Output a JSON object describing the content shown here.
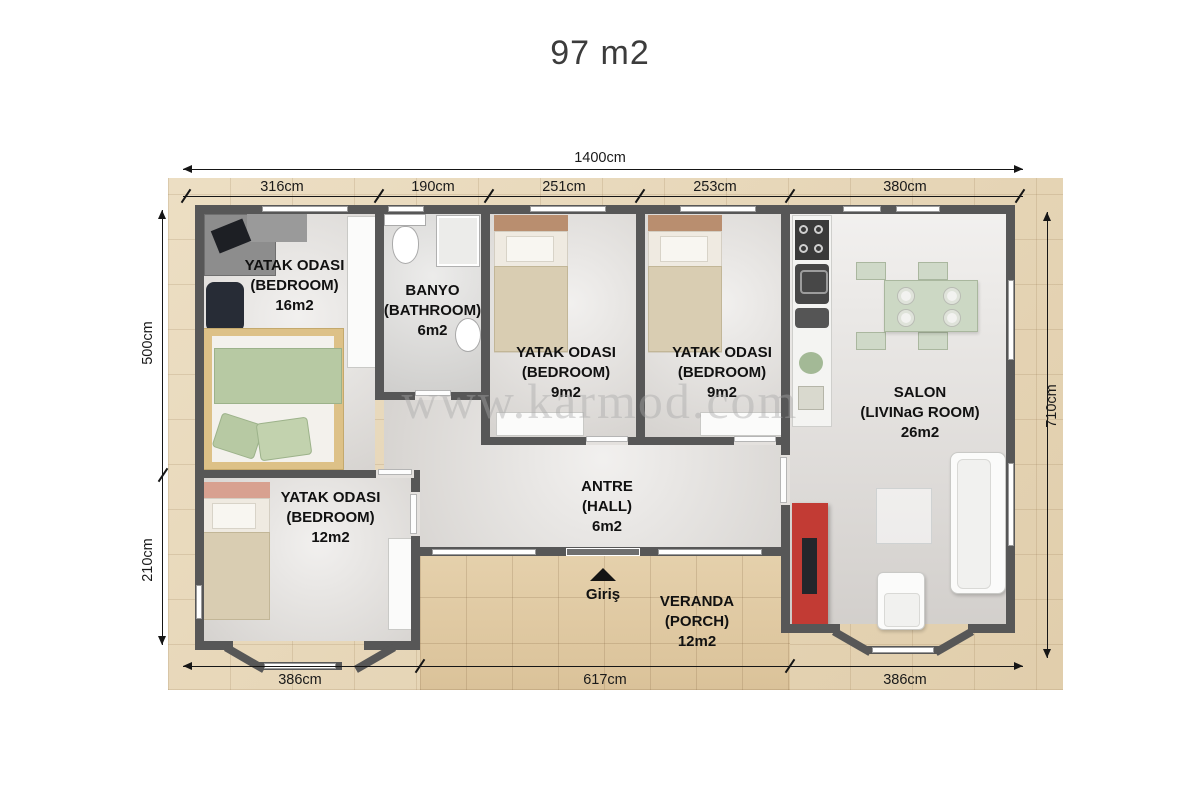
{
  "title": "97 m2",
  "watermark": "www.karmod.com",
  "colors": {
    "wall": "#575757",
    "mat": "#e8d7b6",
    "veranda": "#e2cba2",
    "floor": "#e4e1de",
    "salon_floor": "#e7e4e1",
    "accent_red": "#c23b34",
    "bed_green": "#b7c9a3",
    "bed_frame": "#ddc187",
    "bed_tan": "#d9cdb2",
    "headboard_brown": "#b98e6f",
    "headboard_peach": "#d8a190",
    "dim_text": "#1a1a1a",
    "watermark_gray": "#a8a8a8"
  },
  "dims": {
    "top_total": "1400cm",
    "top_segments": [
      "316cm",
      "190cm",
      "251cm",
      "253cm",
      "380cm"
    ],
    "left_top": "500cm",
    "left_bottom": "210cm",
    "right": "710cm",
    "bottom": [
      "386cm",
      "617cm",
      "386cm"
    ]
  },
  "rooms": [
    {
      "name": "YATAK ODASI",
      "sub": "(BEDROOM)",
      "area": "16m2"
    },
    {
      "name": "BANYO",
      "sub": "(BATHROOM)",
      "area": "6m2"
    },
    {
      "name": "YATAK ODASI",
      "sub": "(BEDROOM)",
      "area": "9m2"
    },
    {
      "name": "YATAK ODASI",
      "sub": "(BEDROOM)",
      "area": "9m2"
    },
    {
      "name": "SALON",
      "sub": "(LIVINaG ROOM)",
      "area": "26m2"
    },
    {
      "name": "YATAK ODASI",
      "sub": "(BEDROOM)",
      "area": "12m2"
    },
    {
      "name": "ANTRE",
      "sub": "(HALL)",
      "area": "6m2"
    },
    {
      "name": "VERANDA",
      "sub": "(PORCH)",
      "area": "12m2"
    }
  ],
  "entrance": {
    "label": "Giriş"
  }
}
